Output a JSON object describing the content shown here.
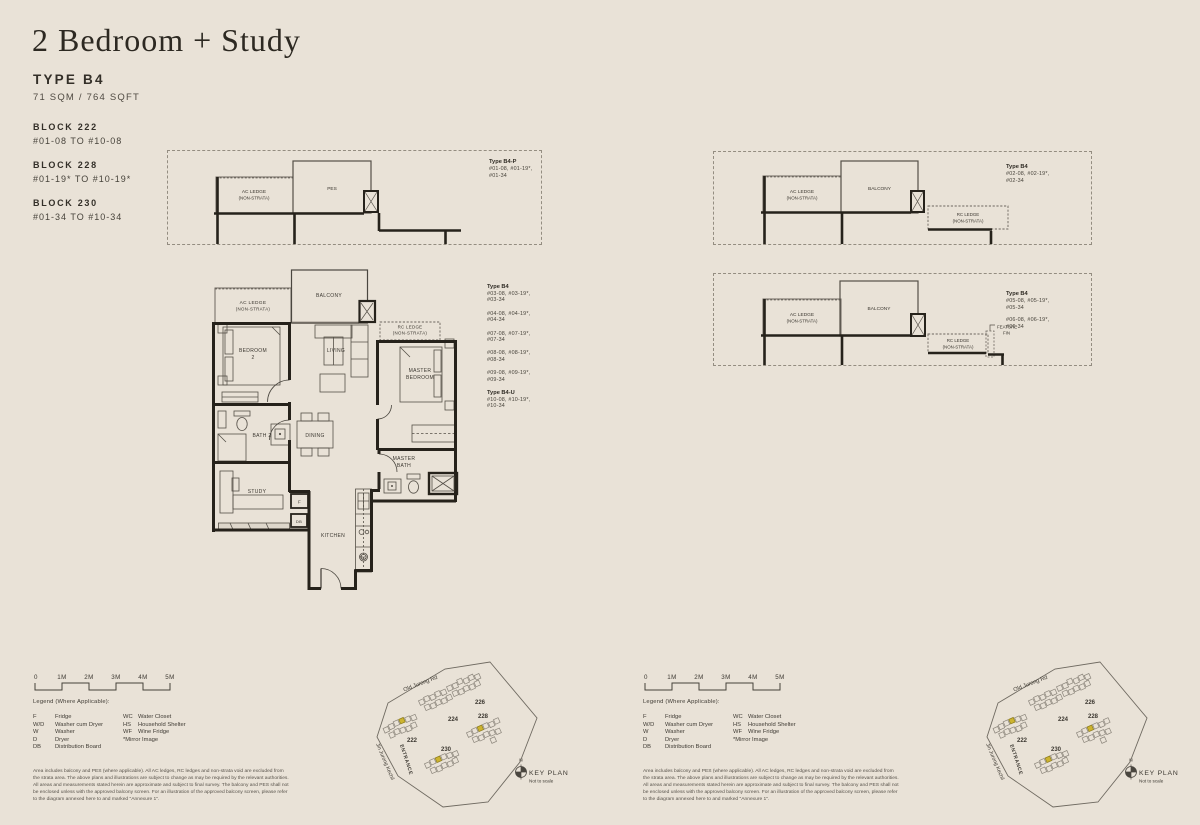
{
  "header": {
    "title": "2 Bedroom + Study",
    "type": "TYPE B4",
    "area": "71 SQM / 764 SQFT",
    "blocks": [
      {
        "name": "BLOCK 222",
        "range": "#01-08 TO #10-08"
      },
      {
        "name": "BLOCK 228",
        "range": "#01-19* TO #10-19*"
      },
      {
        "name": "BLOCK 230",
        "range": "#01-34 TO #10-34"
      }
    ]
  },
  "labels": {
    "ac_ledge": "AC LEDGE",
    "non_strata": "(NON-STRATA)",
    "pes": "PES",
    "balcony": "BALCONY",
    "rc_ledge": "RC LEDGE",
    "feature_fin_line1": "FEATURE",
    "feature_fin_line2": "FIN"
  },
  "rooms": {
    "bedroom2_line1": "BEDROOM",
    "bedroom2_line2": "2",
    "living": "LIVING",
    "master_line1": "MASTER",
    "master_line2": "BEDROOM",
    "bath2": "BATH 2",
    "dining": "DINING",
    "master_bath_line1": "MASTER",
    "master_bath_line2": "BATH",
    "study": "STUDY",
    "fridge": "F",
    "db": "DB",
    "kitchen": "KITCHEN",
    "wd": "W/D"
  },
  "panels": {
    "b4p": {
      "title": "Type B4-P",
      "lines": [
        "#01-08, #01-19*,",
        "#01-34"
      ]
    },
    "b4_02": {
      "title": "Type B4",
      "lines": [
        "#02-08, #02-19*,",
        "#02-34"
      ]
    },
    "b4_0506": {
      "title": "Type B4",
      "lines1": [
        "#05-08, #05-19*,",
        "#05-34"
      ],
      "lines2": [
        "#06-08, #06-19*,",
        "#06-34"
      ]
    }
  },
  "main_units": [
    {
      "title": "Type B4",
      "lines": [
        "#03-08, #03-19*,",
        "#03-34"
      ]
    },
    {
      "title": "",
      "lines": [
        "#04-08, #04-19*,",
        "#04-34"
      ]
    },
    {
      "title": "",
      "lines": [
        "#07-08, #07-19*,",
        "#07-34"
      ]
    },
    {
      "title": "",
      "lines": [
        "#08-08, #08-19*,",
        "#08-34"
      ]
    },
    {
      "title": "",
      "lines": [
        "#09-08, #09-19*,",
        "#09-34"
      ]
    },
    {
      "title": "Type B4-U",
      "lines": [
        "#10-08, #10-19*,",
        "#10-34"
      ]
    }
  ],
  "scalebar": {
    "labels": [
      "0",
      "1M",
      "2M",
      "3M",
      "4M",
      "5M"
    ]
  },
  "legend": {
    "heading": "Legend (Where Applicable):",
    "col1": [
      {
        "abbr": "F",
        "label": "Fridge"
      },
      {
        "abbr": "W/D",
        "label": "Washer cum Dryer"
      },
      {
        "abbr": "W",
        "label": "Washer"
      },
      {
        "abbr": "D",
        "label": "Dryer"
      },
      {
        "abbr": "DB",
        "label": "Distribution Board"
      }
    ],
    "col2": [
      {
        "abbr": "WC",
        "label": "Water Closet"
      },
      {
        "abbr": "HS",
        "label": "Household Shelter"
      },
      {
        "abbr": "WF",
        "label": "Wine Fridge"
      },
      {
        "abbr": "*Mirror Image",
        "label": ""
      }
    ],
    "disclaimer": [
      "Area includes balcony and PES (where applicable). All AC ledges, RC ledges and non-strata void are excluded from",
      "the strata area. The above plans and illustrations are subject to change as may be required by the relevant authorities.",
      "All areas and measurements stated herein are approximate and subject to final survey. The balcony and PES shall not",
      "be enclosed unless with the approved balcony screen. For an illustration of the approved balcony screen, please refer",
      "to the diagram annexed here to and marked \"Annexure 1\"."
    ]
  },
  "keyplan": {
    "road_top": "Old Jurong Rd",
    "road_left": "Jln Jurong Kechil",
    "entrance": "ENTRANCE",
    "compass": "N",
    "title": "KEY PLAN",
    "subtitle": "Not to scale",
    "block_labels": [
      "222",
      "224",
      "226",
      "228",
      "230"
    ],
    "highlight_color": "#cdb42f"
  }
}
